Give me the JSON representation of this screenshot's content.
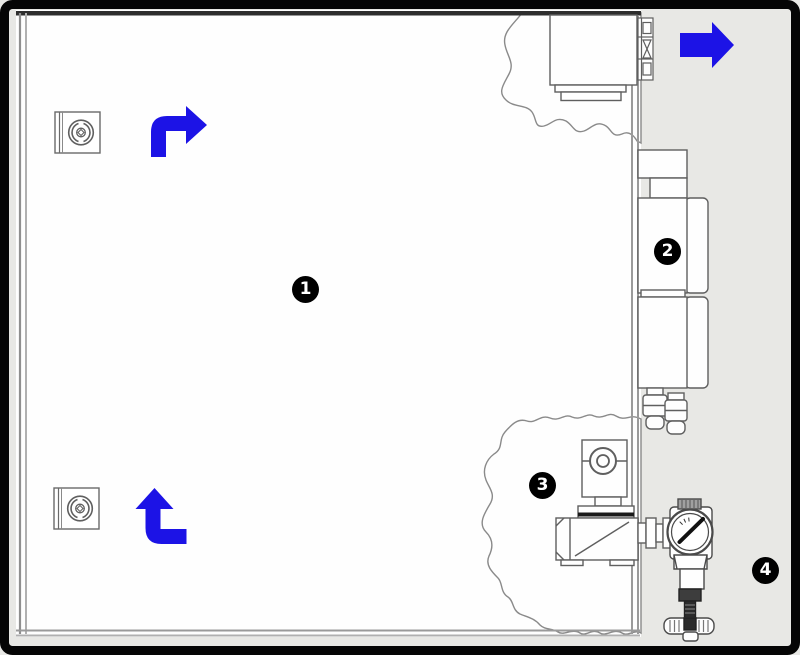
{
  "figure": {
    "type": "equipment-airflow-diagram",
    "callouts": [
      {
        "id": "callout-1",
        "number": "1"
      },
      {
        "id": "callout-2",
        "number": "2"
      },
      {
        "id": "callout-3",
        "number": "3"
      },
      {
        "id": "callout-4",
        "number": "4"
      }
    ],
    "colors": {
      "flow_arrow_blue": "#1c13e6",
      "canvas_background": "#e8e8e5",
      "chamber_fill": "#ffffff",
      "line_work": "#5f5f5f",
      "wall_gray": "#9a9a9a",
      "frame_border": "#000000",
      "callout_background": "#000000",
      "callout_text": "#ffffff"
    }
  }
}
